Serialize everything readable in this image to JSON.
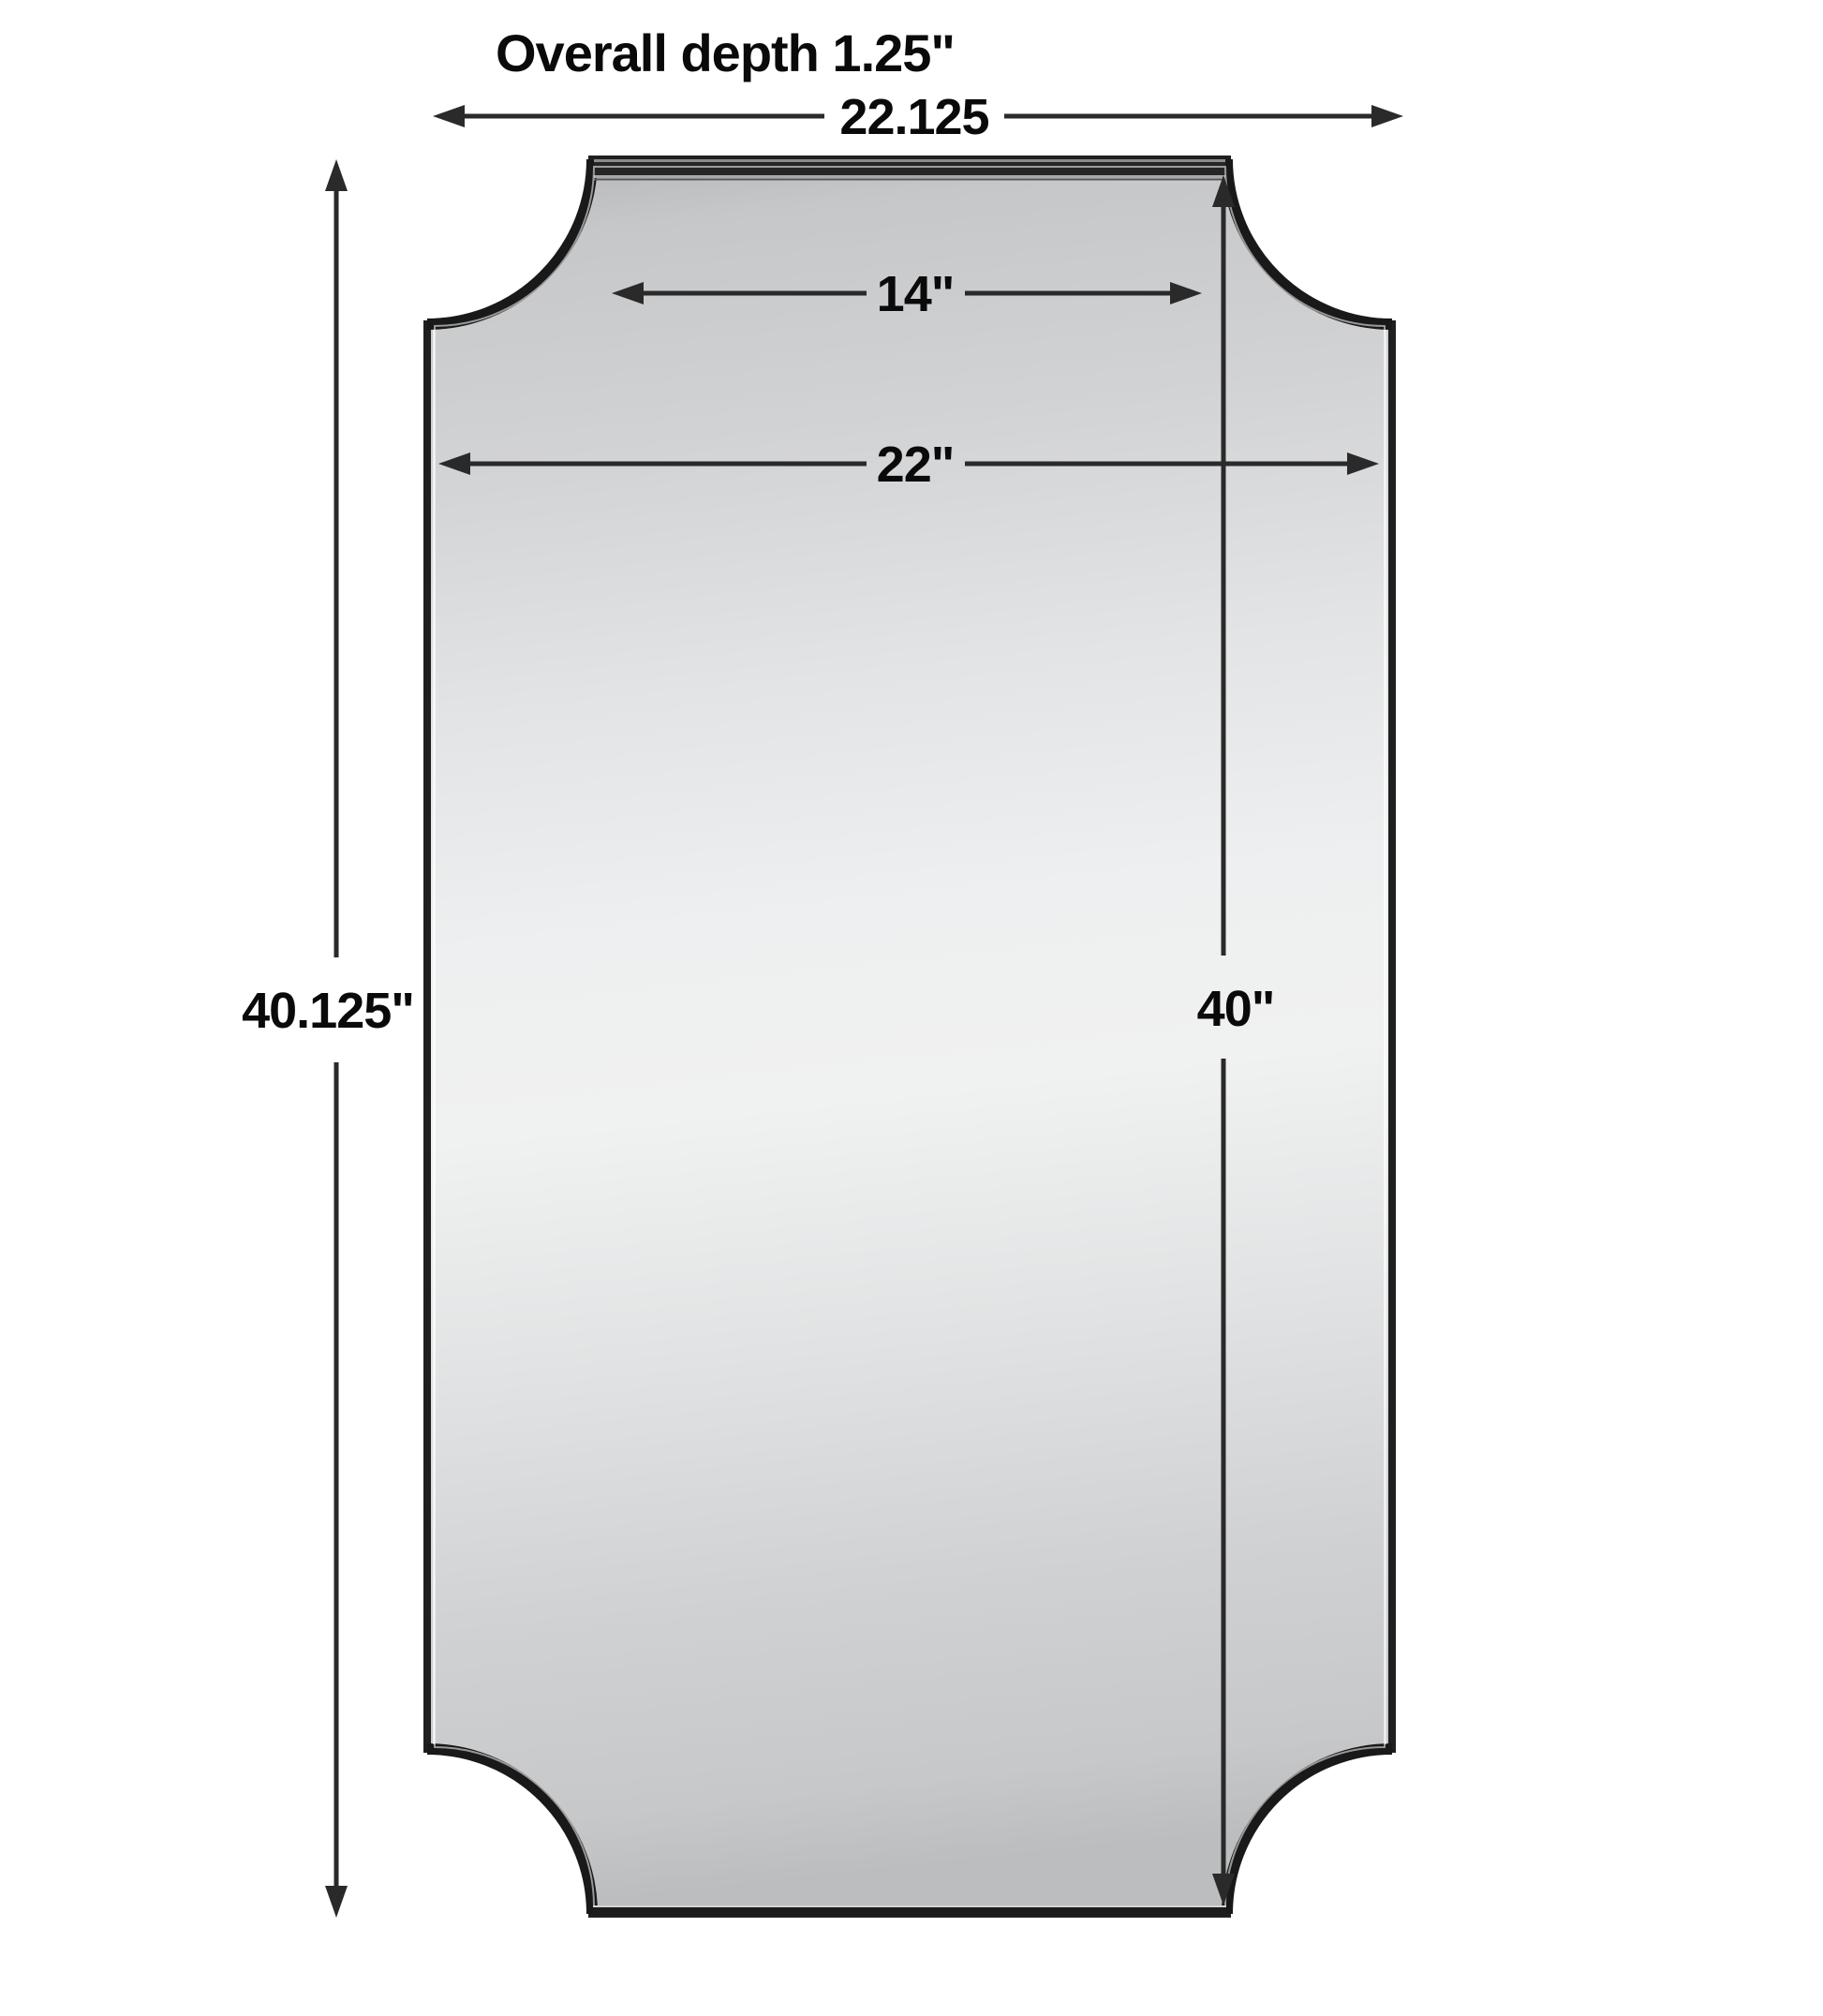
{
  "title": "Overall depth 1.25\"",
  "dimensions": {
    "overall_width": "22.125",
    "top_width": "14\"",
    "mirror_width": "22\"",
    "overall_height": "40.125\"",
    "mirror_height": "40\""
  },
  "colors": {
    "background": "#ffffff",
    "line": "#2a2a2a",
    "ink": "#0a0a0a",
    "frame": "#1f1f1f",
    "glass_light": "#f0f1f1",
    "glass_dark": "#bcbdbf"
  }
}
